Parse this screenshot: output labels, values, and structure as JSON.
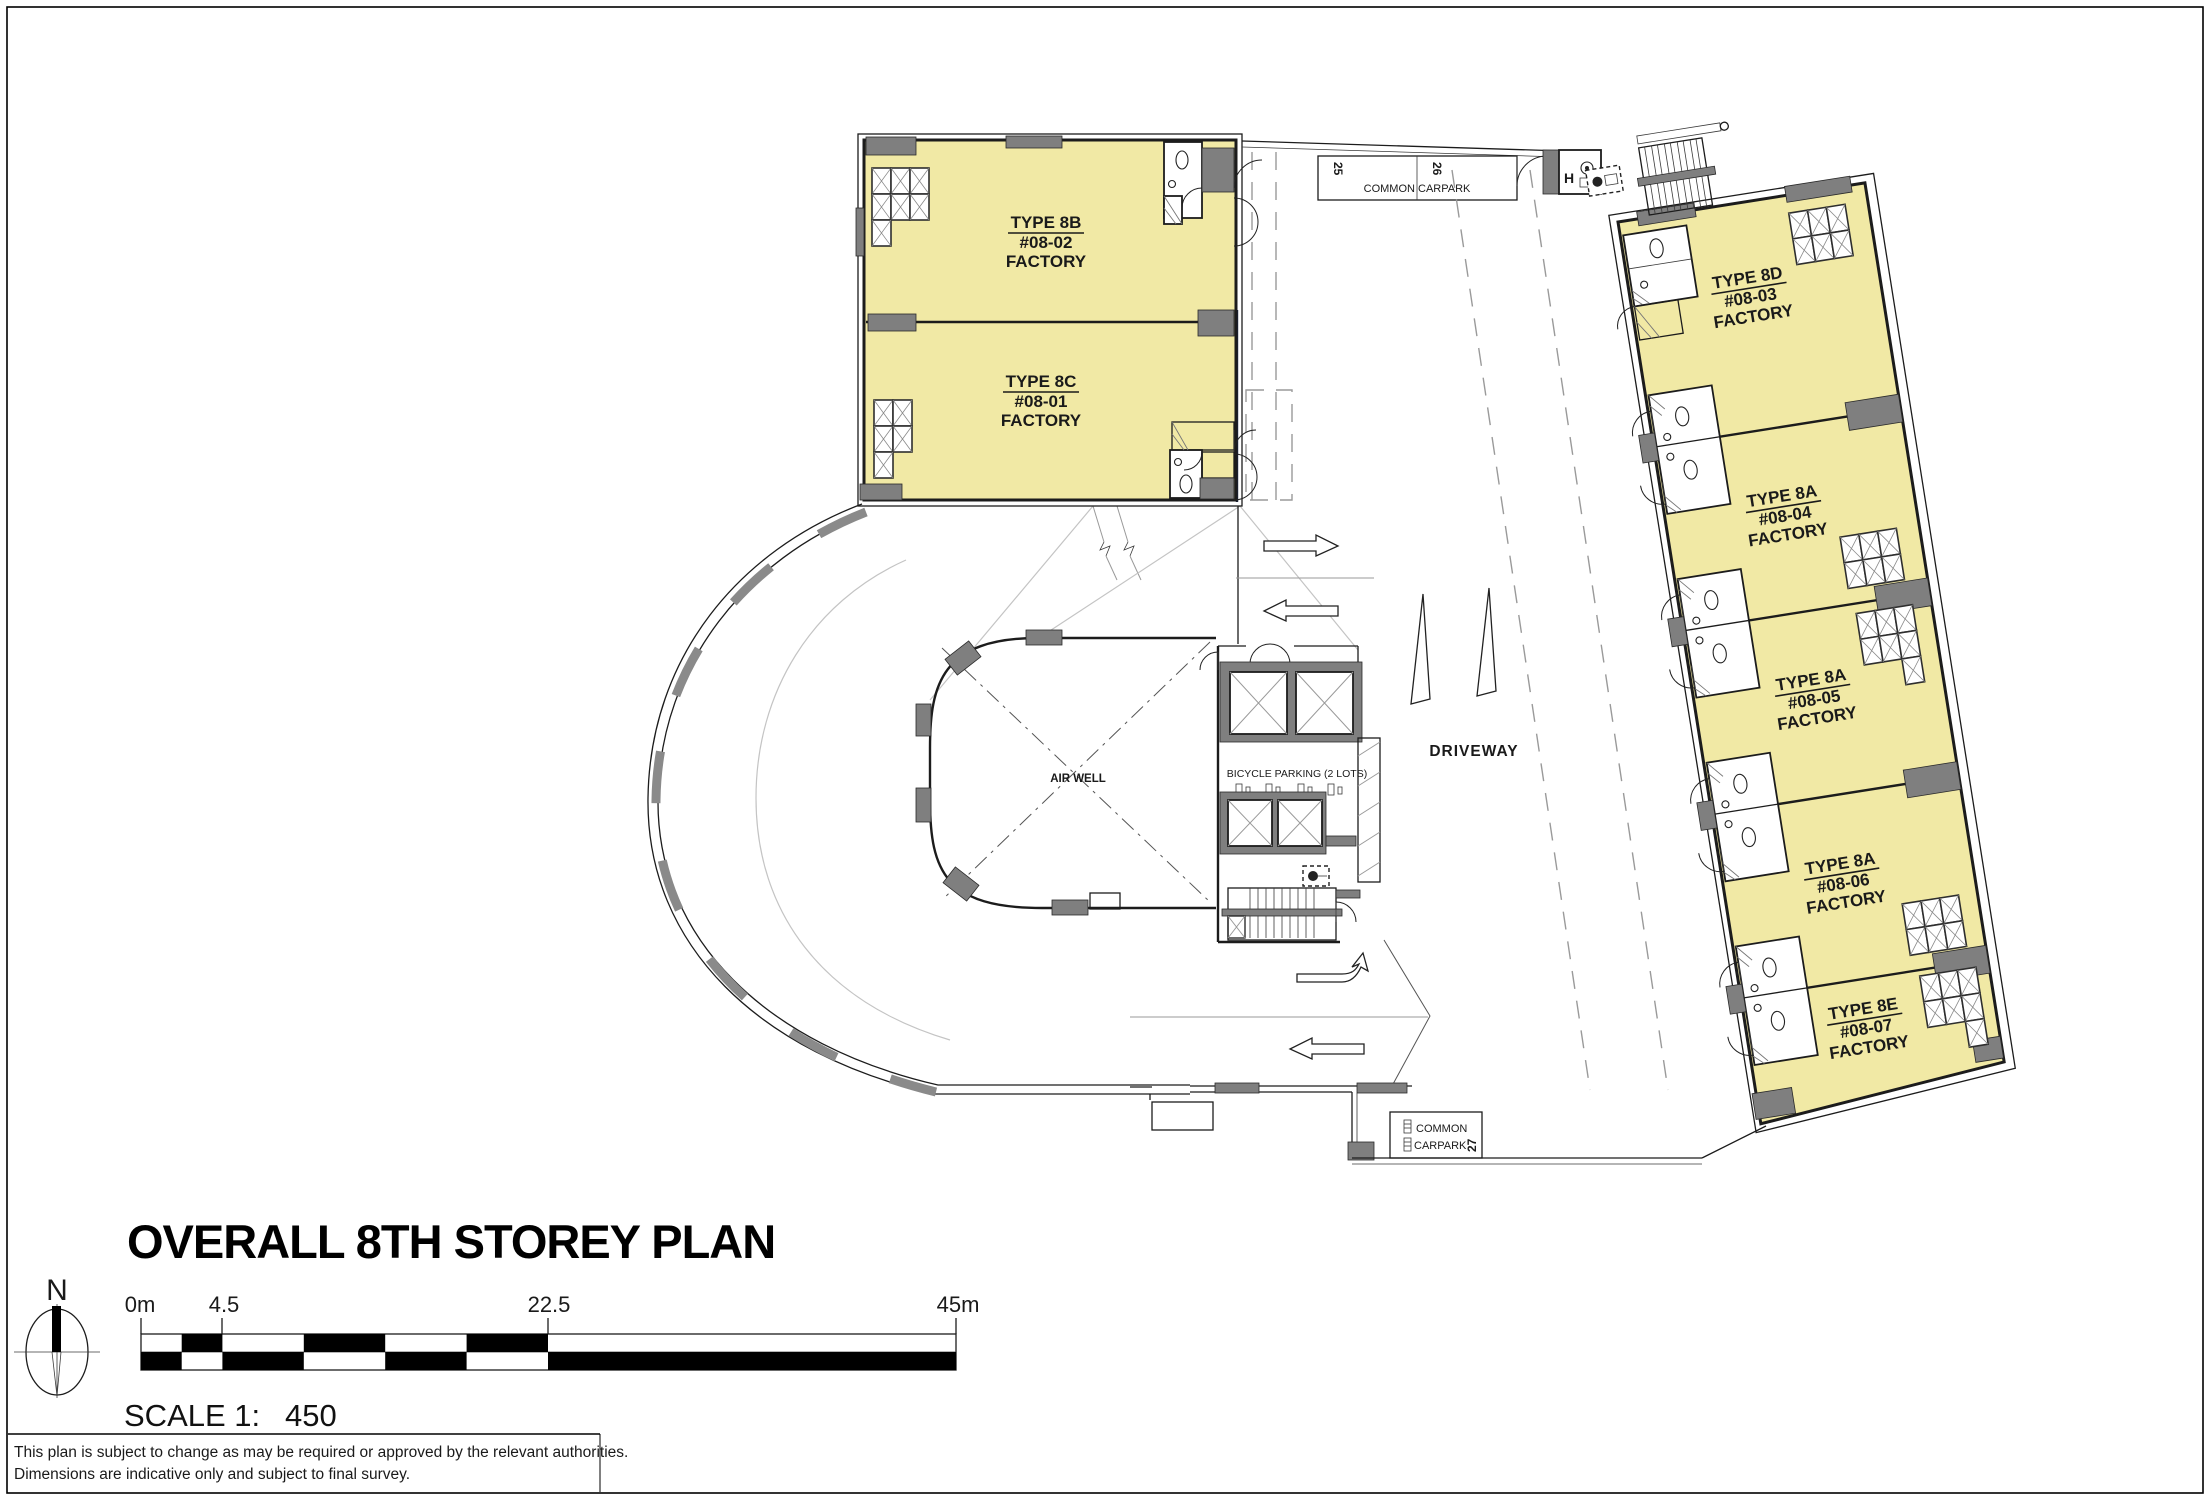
{
  "page": {
    "title": "OVERALL 8TH STOREY PLAN",
    "scale_prefix": "SCALE 1:",
    "scale_value": "450",
    "north": "N",
    "note1": "This plan is subject to change as may be required or approved by the relevant authorities.",
    "note2": "Dimensions are indicative only and subject to final survey.",
    "scalebar": {
      "t0": "0m",
      "t1": "4.5",
      "t2": "22.5",
      "t3": "45m"
    }
  },
  "units": {
    "u8b": {
      "type": "TYPE 8B",
      "no": "#08-02",
      "use": "FACTORY"
    },
    "u8c": {
      "type": "TYPE 8C",
      "no": "#08-01",
      "use": "FACTORY"
    },
    "u8d": {
      "type": "TYPE 8D",
      "no": "#08-03",
      "use": "FACTORY"
    },
    "u8a4": {
      "type": "TYPE 8A",
      "no": "#08-04",
      "use": "FACTORY"
    },
    "u8a5": {
      "type": "TYPE 8A",
      "no": "#08-05",
      "use": "FACTORY"
    },
    "u8a6": {
      "type": "TYPE 8A",
      "no": "#08-06",
      "use": "FACTORY"
    },
    "u8e": {
      "type": "TYPE 8E",
      "no": "#08-07",
      "use": "FACTORY"
    }
  },
  "labels": {
    "driveway": "DRIVEWAY",
    "airwell": "AIR WELL",
    "bicycle": "BICYCLE PARKING (2 LOTS)",
    "carpark_full": "COMMON CARPARK",
    "carpark_line1": "COMMON",
    "carpark_line2": "CARPARK",
    "lot25": "25",
    "lot26": "26",
    "lot27": "27",
    "hosereel": "H"
  },
  "colors": {
    "unit_fill": "#F1E9A5",
    "column": "#7F7F7F",
    "wall": "#1C1C1C",
    "carpark_text": "#27323F"
  }
}
